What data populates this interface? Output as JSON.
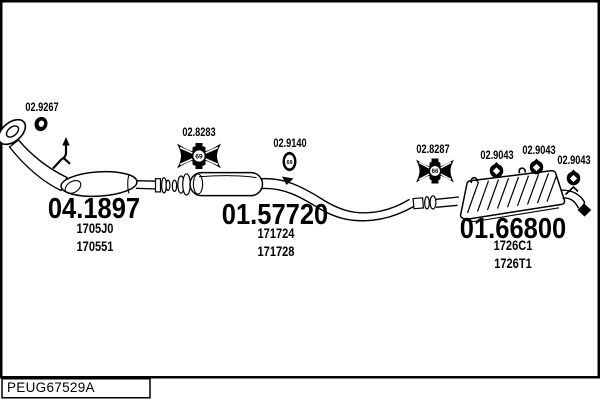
{
  "colors": {
    "line": "#000000",
    "background": "#ffffff"
  },
  "labels": {
    "front_gasket": "02.9267",
    "mid_clamp": "02.8283",
    "mid_mount": "02.9140",
    "rear_clamp": "02.8287",
    "rear_hanger_1": "02.9043",
    "rear_hanger_2": "02.9043",
    "rear_hanger_3": "02.9043"
  },
  "icon_codes": {
    "mid_clamp": "69",
    "mid_mount": "69",
    "rear_clamp": "66"
  },
  "parts": {
    "front_section": {
      "number": "04.1897",
      "oe_ref_1": "1705J0",
      "oe_ref_2": "170551"
    },
    "middle_silencer": {
      "number": "01.57720",
      "oe_ref_1": "171724",
      "oe_ref_2": "171728"
    },
    "rear_silencer": {
      "number": "01.66800",
      "oe_ref_1": "1726C1",
      "oe_ref_2": "1726T1"
    }
  },
  "footer": {
    "diagram_ref": "PEUG67529A"
  }
}
